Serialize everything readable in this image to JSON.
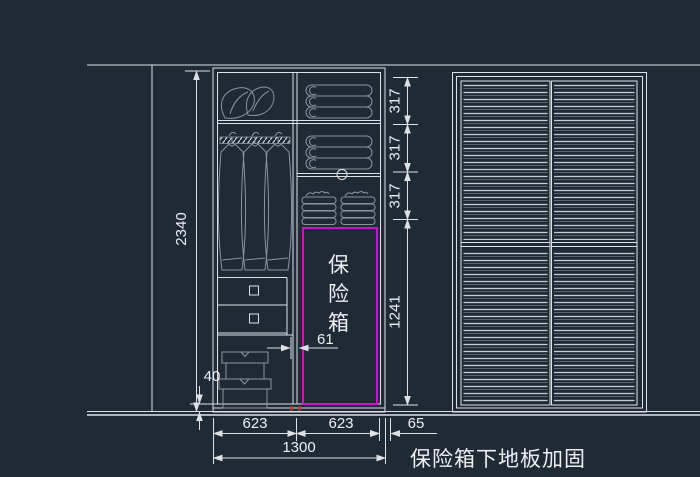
{
  "drawing": {
    "annotation": "保险箱下地板加固",
    "safe_label": [
      "保",
      "险",
      "箱"
    ],
    "dims": {
      "total_height": "2340",
      "shelf_seg_1": "317",
      "shelf_seg_2": "317",
      "shelf_seg_3": "317",
      "safe_zone_height": "1241",
      "safe_side_gap": "61",
      "plinth_height": "40",
      "bay_left": "623",
      "bay_right": "623",
      "unit_gap": "65",
      "total_width": "1300"
    },
    "colors": {
      "background": "#202a35",
      "line": "#dde1e6",
      "furniture": "#8a94a0",
      "safe_outline": "#cf10cf",
      "marker_red": "#c23230",
      "text": "#edf0f3"
    }
  }
}
